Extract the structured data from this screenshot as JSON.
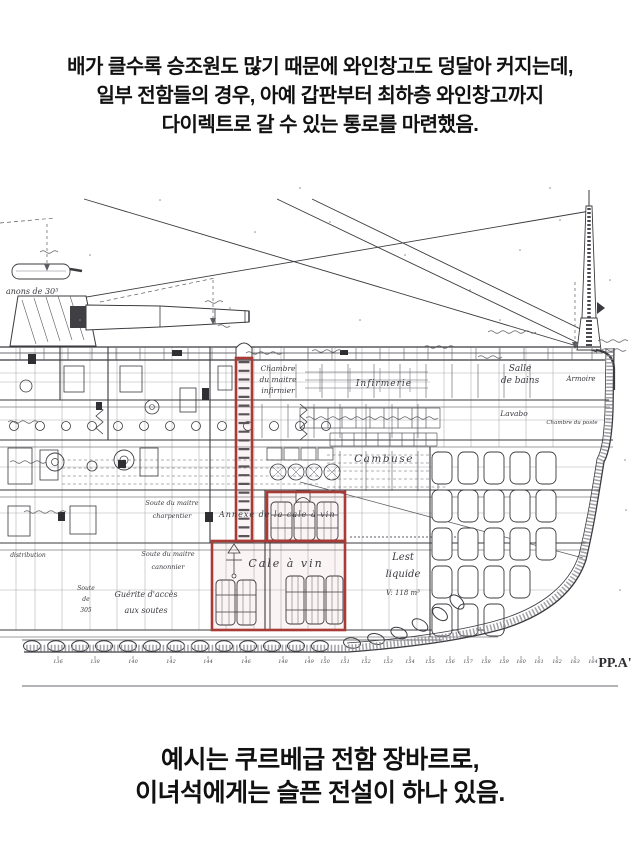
{
  "top_caption": {
    "lines": [
      "배가 클수록 승조원도 많기 때문에 와인창고도 덩달아 커지는데,",
      "일부 전함들의 경우, 아예 갑판부터 최하층 와인창고까지",
      "다이렉트로 갈 수 있는 통로를 마련했음."
    ]
  },
  "bottom_caption": {
    "lines": [
      "예시는 쿠르베급 전함 장바르로,",
      "이녀석에게는 슬픈 전설이 하나 있음."
    ]
  },
  "blueprint": {
    "highlight_color": "#a83b36",
    "ink_color": "#3b3b40",
    "plate_label": {
      "text": "PP.A'"
    },
    "highlights": [
      {
        "name": "direct-passage-shaft",
        "x": 236,
        "y": 198,
        "w": 16,
        "h": 183
      },
      {
        "name": "wine-cellar-annex-box",
        "x": 267,
        "y": 332,
        "w": 78,
        "h": 49
      },
      {
        "name": "wine-cellar-box",
        "x": 212,
        "y": 381,
        "w": 133,
        "h": 89
      }
    ],
    "labels": [
      {
        "text": "anons de 30⁵",
        "x": 6,
        "y": 134,
        "size": 8,
        "anchor": "start"
      },
      {
        "text": "Chambre",
        "x": 278,
        "y": 211,
        "size": 7.5
      },
      {
        "text": "du maitre",
        "x": 278,
        "y": 222,
        "size": 7.5
      },
      {
        "text": "infirmier",
        "x": 278,
        "y": 233,
        "size": 7.5
      },
      {
        "text": "Infirmerie",
        "x": 384,
        "y": 226,
        "size": 9,
        "ls": 1
      },
      {
        "text": "Salle",
        "x": 520,
        "y": 211,
        "size": 9
      },
      {
        "text": "de bains",
        "x": 520,
        "y": 223,
        "size": 9
      },
      {
        "text": "Armoire",
        "x": 581,
        "y": 221,
        "size": 7
      },
      {
        "text": "Lavabo",
        "x": 514,
        "y": 256,
        "size": 7.5
      },
      {
        "text": "Chambre du poste",
        "x": 572,
        "y": 264,
        "size": 5.5
      },
      {
        "text": "Cambuse",
        "x": 384,
        "y": 302,
        "size": 10.5,
        "ls": 1.5
      },
      {
        "text": "Annexe de  la cale à vin",
        "x": 219,
        "y": 357,
        "size": 8,
        "anchor": "start",
        "ls": 1
      },
      {
        "text": "Cale  à  vin",
        "x": 286,
        "y": 407,
        "size": 11,
        "ls": 2
      },
      {
        "text": "Lest",
        "x": 403,
        "y": 400,
        "size": 10
      },
      {
        "text": "liquide",
        "x": 403,
        "y": 417,
        "size": 10
      },
      {
        "text": "V: 118 m³",
        "x": 403,
        "y": 435,
        "size": 7
      },
      {
        "text": "Soute du maitre",
        "x": 172,
        "y": 345,
        "size": 6.5
      },
      {
        "text": "charpentier",
        "x": 172,
        "y": 358,
        "size": 6.5
      },
      {
        "text": "Soute du maitre",
        "x": 168,
        "y": 396,
        "size": 6.5
      },
      {
        "text": "canonnier",
        "x": 168,
        "y": 409,
        "size": 6.5
      },
      {
        "text": "Guérite  d'accès",
        "x": 146,
        "y": 437,
        "size": 8
      },
      {
        "text": "aux  soutes",
        "x": 146,
        "y": 453,
        "size": 8
      },
      {
        "text": "Soute",
        "x": 86,
        "y": 430,
        "size": 6
      },
      {
        "text": "de",
        "x": 86,
        "y": 441,
        "size": 6
      },
      {
        "text": "305",
        "x": 86,
        "y": 452,
        "size": 6
      },
      {
        "text": "distribution",
        "x": 28,
        "y": 397,
        "size": 6
      }
    ],
    "frame_scale": {
      "y": 503,
      "ticks": [
        {
          "n": "136",
          "x": 58
        },
        {
          "n": "138",
          "x": 95
        },
        {
          "n": "140",
          "x": 133
        },
        {
          "n": "142",
          "x": 171
        },
        {
          "n": "144",
          "x": 208
        },
        {
          "n": "146",
          "x": 246
        },
        {
          "n": "148",
          "x": 283
        },
        {
          "n": "149",
          "x": 309
        },
        {
          "n": "150",
          "x": 325
        },
        {
          "n": "151",
          "x": 345
        },
        {
          "n": "152",
          "x": 366
        },
        {
          "n": "153",
          "x": 388
        },
        {
          "n": "154",
          "x": 410
        },
        {
          "n": "155",
          "x": 430
        },
        {
          "n": "156",
          "x": 450
        },
        {
          "n": "157",
          "x": 468
        },
        {
          "n": "158",
          "x": 486
        },
        {
          "n": "159",
          "x": 504
        },
        {
          "n": "160",
          "x": 521
        },
        {
          "n": "161",
          "x": 539
        },
        {
          "n": "162",
          "x": 557
        },
        {
          "n": "163",
          "x": 575
        },
        {
          "n": "164",
          "x": 593
        }
      ]
    }
  }
}
